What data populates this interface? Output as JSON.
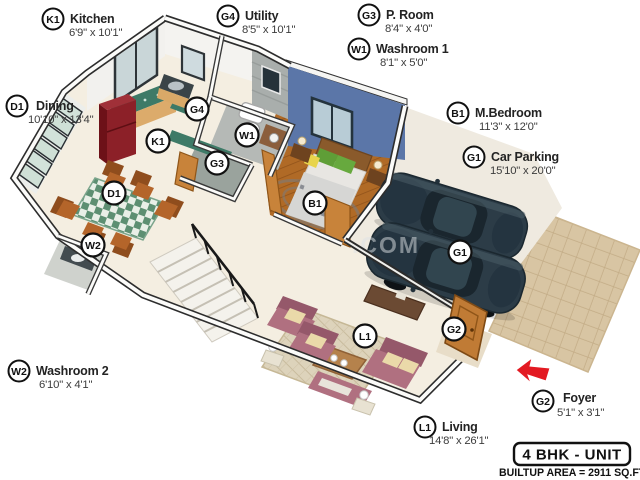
{
  "floorplan": {
    "title": "4 BHK - UNIT",
    "builtup_area": "BUILTUP AREA = 2911 SQ.FT.",
    "watermark": ".COM",
    "legend": [
      {
        "id": "K1",
        "name": "Kitchen",
        "dims": "6'9\" x 10'1\""
      },
      {
        "id": "G4",
        "name": "Utility",
        "dims": "8'5\" x 10'1\""
      },
      {
        "id": "G3",
        "name": "P. Room",
        "dims": "8'4\" x 4'0\""
      },
      {
        "id": "W1",
        "name": "Washroom 1",
        "dims": "8'1\" x 5'0\""
      },
      {
        "id": "D1",
        "name": "Dining",
        "dims": "10'10\" x 13'4\""
      },
      {
        "id": "B1",
        "name": "M.Bedroom",
        "dims": "11'3\" x 12'0\""
      },
      {
        "id": "G1",
        "name": "Car Parking",
        "dims": "15'10\" x 20'0\""
      },
      {
        "id": "W2",
        "name": "Washroom 2",
        "dims": "6'10\" x 4'1\""
      },
      {
        "id": "L1",
        "name": "Living",
        "dims": "14'8\" x 26'1\""
      },
      {
        "id": "G2",
        "name": "Foyer",
        "dims": "5'1\" x 3'1\""
      }
    ],
    "plan_labels": [
      {
        "id": "K1"
      },
      {
        "id": "G4"
      },
      {
        "id": "W1"
      },
      {
        "id": "G3"
      },
      {
        "id": "D1"
      },
      {
        "id": "W2"
      },
      {
        "id": "B1"
      },
      {
        "id": "G1"
      },
      {
        "id": "L1"
      },
      {
        "id": "G2"
      }
    ],
    "colors": {
      "accent_wall": "#5b76a8",
      "wood_floor": "#b06a26",
      "sofa": "#b07080",
      "car_body": "#2c3c47",
      "driveway": "#d8c5a3",
      "entry_arrow": "#e31a22",
      "counter_top": "#3e7a67",
      "fridge": "#8c2028"
    }
  }
}
